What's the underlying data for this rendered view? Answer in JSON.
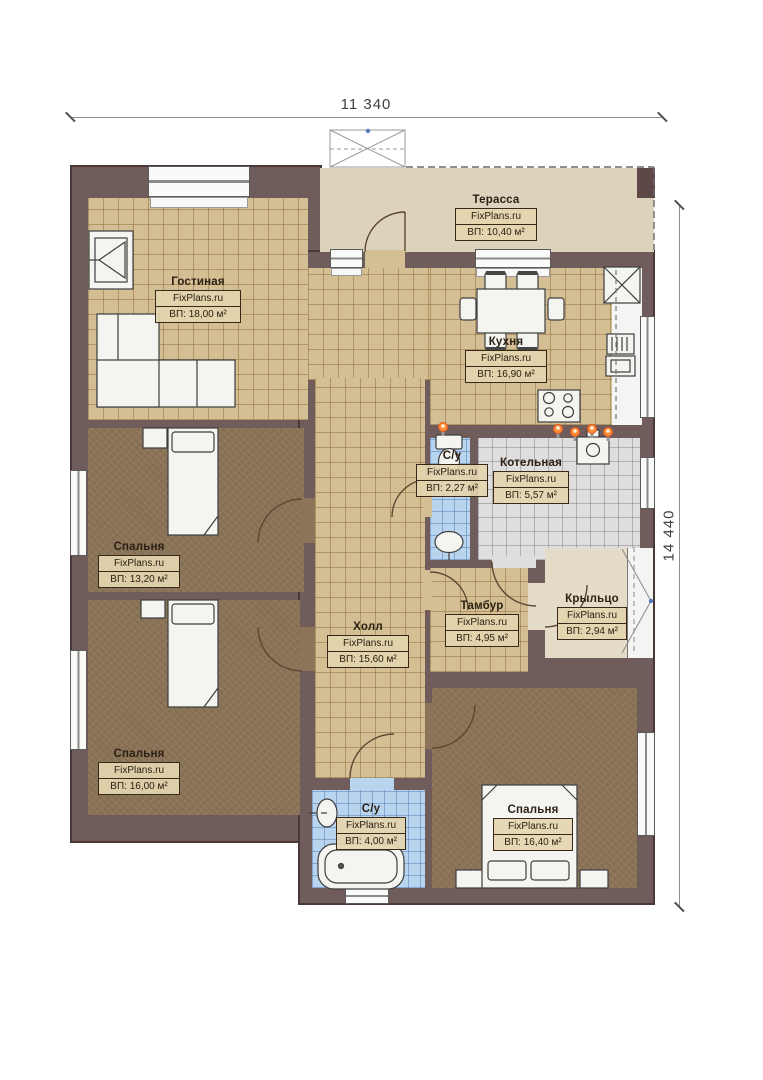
{
  "watermark": "FixPlans.ru",
  "dimensions": {
    "width_label": "11 340",
    "height_label": "14 440"
  },
  "rooms": [
    {
      "id": "terrace",
      "name": "Терасса",
      "area": "ВП: 10,40 м²"
    },
    {
      "id": "living",
      "name": "Гостиная",
      "area": "ВП: 18,00 м²"
    },
    {
      "id": "kitchen",
      "name": "Кухня",
      "area": "ВП: 16,90 м²"
    },
    {
      "id": "bedroom-1",
      "name": "Спальня",
      "area": "ВП: 13,20 м²"
    },
    {
      "id": "bedroom-2",
      "name": "Спальня",
      "area": "ВП: 16,00 м²"
    },
    {
      "id": "hall",
      "name": "Холл",
      "area": "ВП: 15,60 м²"
    },
    {
      "id": "wc-1",
      "name": "С/у",
      "area": "ВП: 2,27 м²"
    },
    {
      "id": "boiler",
      "name": "Котельная",
      "area": "ВП: 5,57 м²"
    },
    {
      "id": "tambour",
      "name": "Тамбур",
      "area": "ВП: 4,95 м²"
    },
    {
      "id": "porch",
      "name": "Крыльцо",
      "area": "ВП: 2,94 м²"
    },
    {
      "id": "wc-2",
      "name": "С/у",
      "area": "ВП: 4,00 м²"
    },
    {
      "id": "bedroom-3",
      "name": "Спальня",
      "area": "ВП: 16,40 м²"
    }
  ],
  "colors": {
    "wall": "#715c5c",
    "floor_tile": "#d4be93",
    "bedroom_floor": "#8b7457",
    "bathroom_tile": "#b9d4ef",
    "boiler_tile": "#dedede",
    "terrace_floor": "#ddd2bb",
    "flame_accent": "#ff8c35",
    "label_border": "#372817"
  }
}
